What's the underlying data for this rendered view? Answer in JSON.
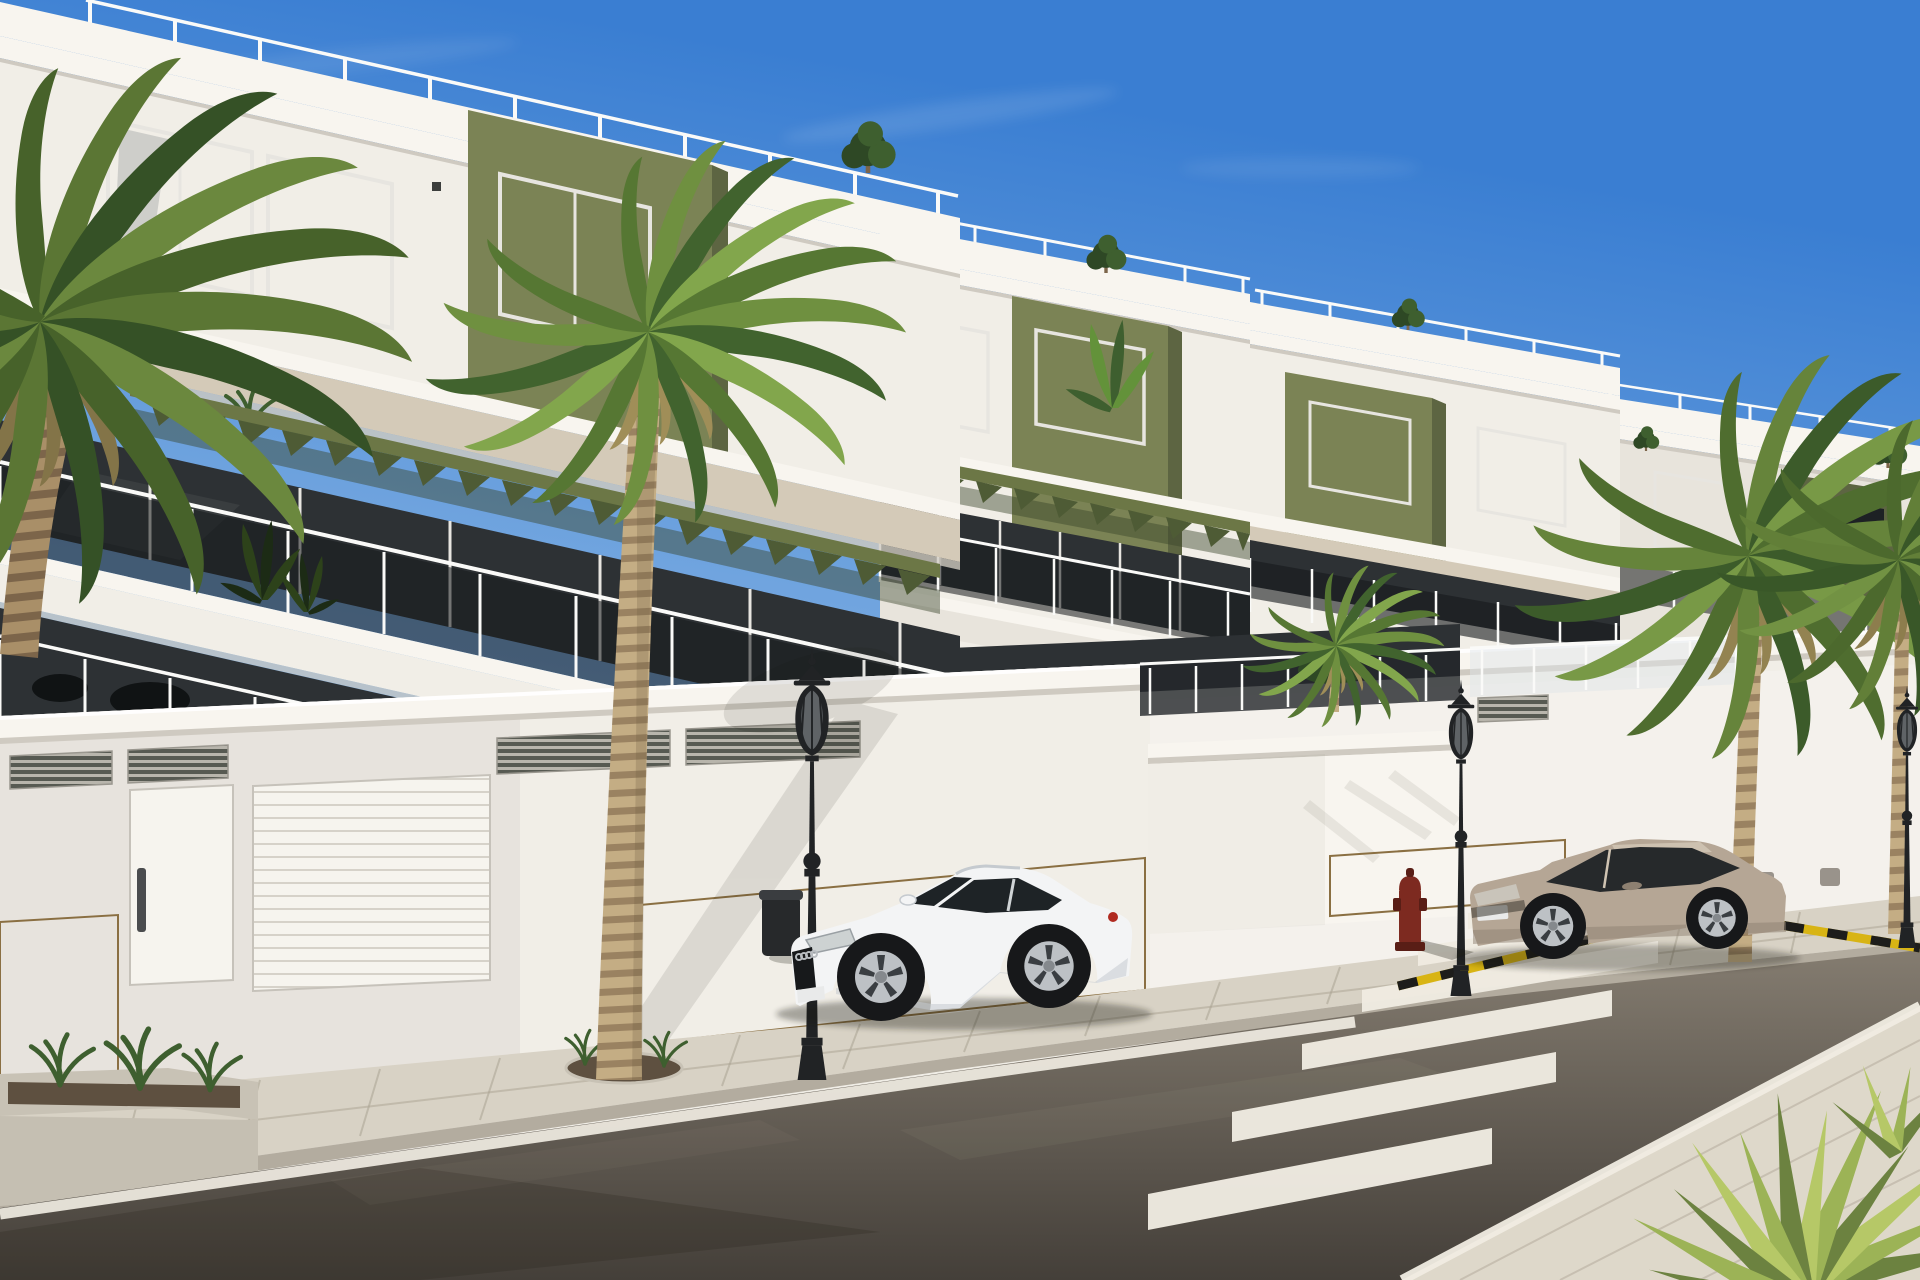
{
  "scene": {
    "type": "architectural-render",
    "description": "Daytime 3D architectural rendering of a terraced modern apartment complex with white and olive-green facades, tinted-glass balcony railings, roof terraces with green pergolas, palm trees along a paved sidewalk, classic black street lamps, a red fire hydrant, a white Audi TT coupe and a beige Renault Megane coupe parked on an asphalt street with a zebra crosswalk and a yellow-and-black curb marking under a clear blue sky.",
    "objects": [
      "sky",
      "clouds",
      "terraced-apartment-building",
      "olive-accent-walls",
      "glass-balconies",
      "roof-terraces",
      "pergolas",
      "street-level-wall",
      "garage-doors",
      "pedestrian-door",
      "vent-grilles",
      "stone-cladding",
      "sidewalk",
      "planters",
      "street-lamps",
      "waste-bin",
      "fire-hydrant",
      "white-coupe-car",
      "beige-coupe-car",
      "asphalt-road",
      "zebra-crosswalk",
      "yellow-black-marking",
      "white-edge-line",
      "palm-trees",
      "rooftop-shrubs",
      "yucca-plant"
    ]
  },
  "colors": {
    "sky_top": "#3a7ed2",
    "sky_mid": "#85b3e4",
    "sky_horizon": "#d3e2f2",
    "cloud_white": "#ffffff",
    "wall_bright": "#f8f5ef",
    "wall_white": "#f1eee7",
    "wall_dim": "#e8e4dc",
    "wall_shade": "#d9d5cc",
    "cornice_shadow": "#cfcac1",
    "fascia_beige": "#d4cab8",
    "olive": "#7b8355",
    "olive_dark": "#5d6542",
    "olive_deep": "#4c5433",
    "glass_dark": "#1d2124",
    "glass_band": "#2d3134",
    "glass_rail": "#16191c",
    "frame_light": "#e7e5e0",
    "railing_post": "#fafaf8",
    "pergola_beam": "#6c7746",
    "pergola_fin": "#4e5b35",
    "pergola_shadow": "#3a442b",
    "stone_base": "#c8a76f",
    "stone_light": "#dcbf8a",
    "stone_mid": "#b2905a",
    "stone_joint": "#8a6f42",
    "garage_white": "#f6f4ee",
    "garage_slat": "#d6d2c9",
    "vent_dark": "#575a52",
    "vent_light": "#b8b5ac",
    "sidewalk": "#d8d2c5",
    "sidewalk_near": "#ded8ca",
    "curb": "#b3ac9f",
    "paver_joint": "#aaa292",
    "road_far": "#847c70",
    "road_near": "#443f39",
    "road_wear": "#262219",
    "road_sheen": "#b6ad9e",
    "line_white": "#f0ece2",
    "marking_yellow": "#d8b414",
    "marking_black": "#1d1d1b",
    "lamp_black": "#212325",
    "lamp_glass": "#94999d",
    "hydrant_red": "#7d2a20",
    "hydrant_dark": "#591e16",
    "trunk_light": "#c4ad84",
    "trunk_dark": "#9a8261",
    "trunk_shade": "#a98f68",
    "trunk_deep": "#7c654a",
    "palm1": "#41632e",
    "palm2": "#567733",
    "palm3": "#6f9040",
    "palm4": "#82a64c",
    "palm_dead": "#a08e58",
    "shrub_dark": "#2e4825",
    "shrub_mid": "#3e5f2f",
    "banana_green": "#63923a",
    "yucca1": "#9cb356",
    "yucca2": "#6c8240",
    "yucca3": "#b6c867",
    "car_white": "#f3f4f5",
    "car_shade": "#c5cacf",
    "car_glass": "#1e2326",
    "wheel_rim": "#bdc1c5",
    "tire": "#17181a",
    "badge_red": "#b02a20",
    "plate_white": "#e9eaea",
    "megane_body": "#b5a695",
    "megane_shade": "#8d8071",
    "megane_glass": "#26292b",
    "megane_roof": "#cdc1b0",
    "soil_dark": "#5e5040",
    "planter_rim": "#c8c2b5",
    "metal_gray": "#99938b",
    "bg_wall": "#d8d7d2",
    "ramp_concrete": "#d5cfc1",
    "shadow_tint": "#14140e"
  }
}
